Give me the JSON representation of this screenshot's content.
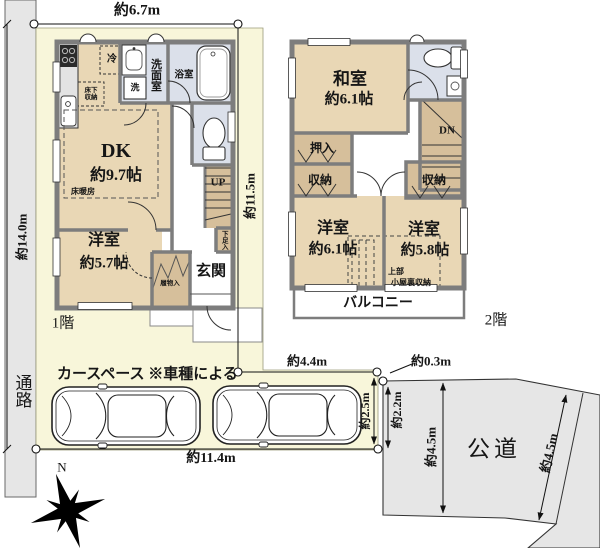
{
  "site": {
    "passage_label": "通路",
    "floor1_tag": "1階",
    "floor2_tag": "2階",
    "car_space_label": "カースペース ※車種による",
    "public_road_label": "公道",
    "north_label": "N"
  },
  "measurements": {
    "top_width": "約6.7m",
    "left_height": "約14.0m",
    "floor1_right_height": "約11.5m",
    "bottom_width": "約11.4m",
    "extension_width": "約4.4m",
    "corner_gap": "約0.3m",
    "car_space_depth": "約2.5m",
    "road_edge": "約2.2m",
    "road_width_vertical": "約4.5m",
    "road_width_diagonal": "約4.5m"
  },
  "floor1": {
    "dk_name": "DK",
    "dk_size": "約9.7帖",
    "youshitsu_name": "洋室",
    "youshitsu_size": "約5.7帖",
    "genkan": "玄関",
    "senmenshitsu": "洗面室",
    "yokushitsu": "浴室",
    "fridge": "冷",
    "washer": "洗",
    "yukashita_shuno": "床下収納",
    "yuka_danbou": "床暖房",
    "stairs_up": "UP",
    "geta_bako": "下足入",
    "hakimono_ire": "履物入"
  },
  "floor2": {
    "washitsu_name": "和室",
    "washitsu_size": "約6.1帖",
    "youshitsu1_name": "洋室",
    "youshitsu1_size": "約6.1帖",
    "youshitsu2_name": "洋室",
    "youshitsu2_size": "約5.8帖",
    "oshiire": "押入",
    "shuno_left": "収納",
    "shuno_right": "収納",
    "stairs_down": "DN",
    "attic_line1": "上部",
    "attic_line2": "小屋裏収納",
    "balcony": "バルコニー"
  },
  "colors": {
    "plot": "#f8f6da",
    "road": "#e6e6e6",
    "room": "#e9d7b5",
    "closet": "#d6bf9b",
    "wet_area": "#dbe0ea",
    "wall": "#7d7d7d"
  }
}
